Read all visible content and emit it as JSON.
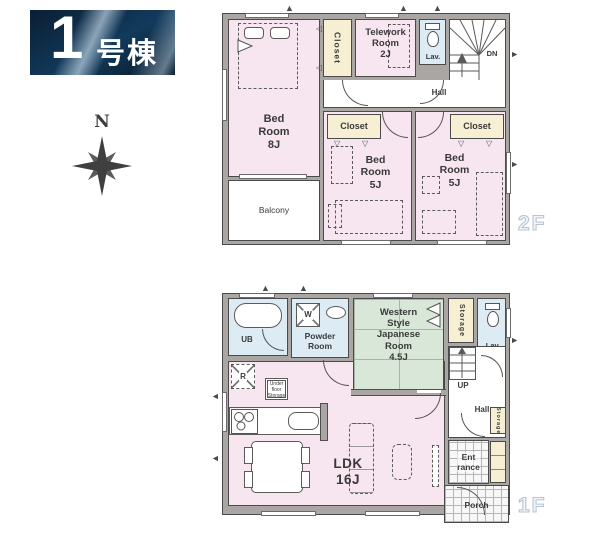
{
  "banner": {
    "number": "1",
    "name": "号棟"
  },
  "compass": {
    "north": "N"
  },
  "floor2": {
    "label": "2F",
    "bedroom8": "Bed\nRoom\n8J",
    "closet_top": "Closet",
    "telework": "Telework\nRoom\n2J",
    "lav": "Lav.",
    "dn": "DN",
    "hall": "Hall",
    "closet_left": "Closet",
    "closet_right": "Closet",
    "bedroom5_left": "Bed\nRoom\n5J",
    "bedroom5_right": "Bed\nRoom\n5J",
    "balcony": "Balcony"
  },
  "floor1": {
    "label": "1F",
    "ub": "UB",
    "washer": "W",
    "powder": "Powder\nRoom",
    "japanese": "Western\nStyle\nJapanese\nRoom\n4.5J",
    "storage_top": "Storage",
    "lav": "Lav.",
    "up": "UP",
    "hall": "Hall",
    "storage_side": "Storage",
    "entrance": "Ent\nrance",
    "porch": "Porch",
    "ldk": "LDK\n16J",
    "fridge": "R",
    "underfloor": "Under\nfloor\nStorage"
  },
  "colors": {
    "room_pink": "#f7e6ef",
    "room_cream": "#f6efd3",
    "room_blue": "#dcebf4",
    "room_green": "#d9e7d8",
    "wall_gray": "#a9a6a4",
    "wall_edge": "#4a4a4a",
    "banner_navy_dark": "#0a1e33",
    "banner_navy": "#123a5c",
    "label_gray": "#3a3a3a",
    "floor_label_stroke": "#b7c5d3",
    "tile_line": "#b5b5b5",
    "tatami_line": "#a3b8a3"
  }
}
